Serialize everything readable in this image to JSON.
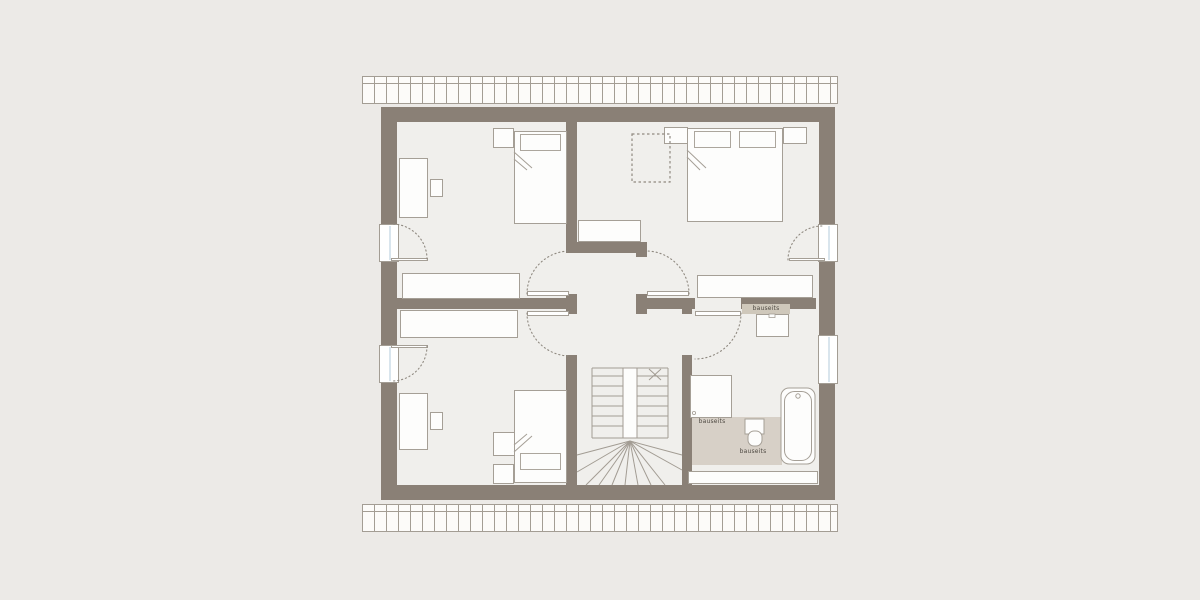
{
  "labels": {
    "vanity_counter": "bauseits",
    "shower_area": "bauseits",
    "bathroom_floor": "bauseits"
  },
  "colors": {
    "wall": "#8a8076",
    "room_floor": "#f0efec",
    "background": "#eceae7",
    "bathroom_floor": "#d7d0c7",
    "vanity_strip": "#cfc8bb",
    "window_glass": "#d9e5ed",
    "stair_line": "#a29c93",
    "swing_arc": "#8f8980"
  }
}
